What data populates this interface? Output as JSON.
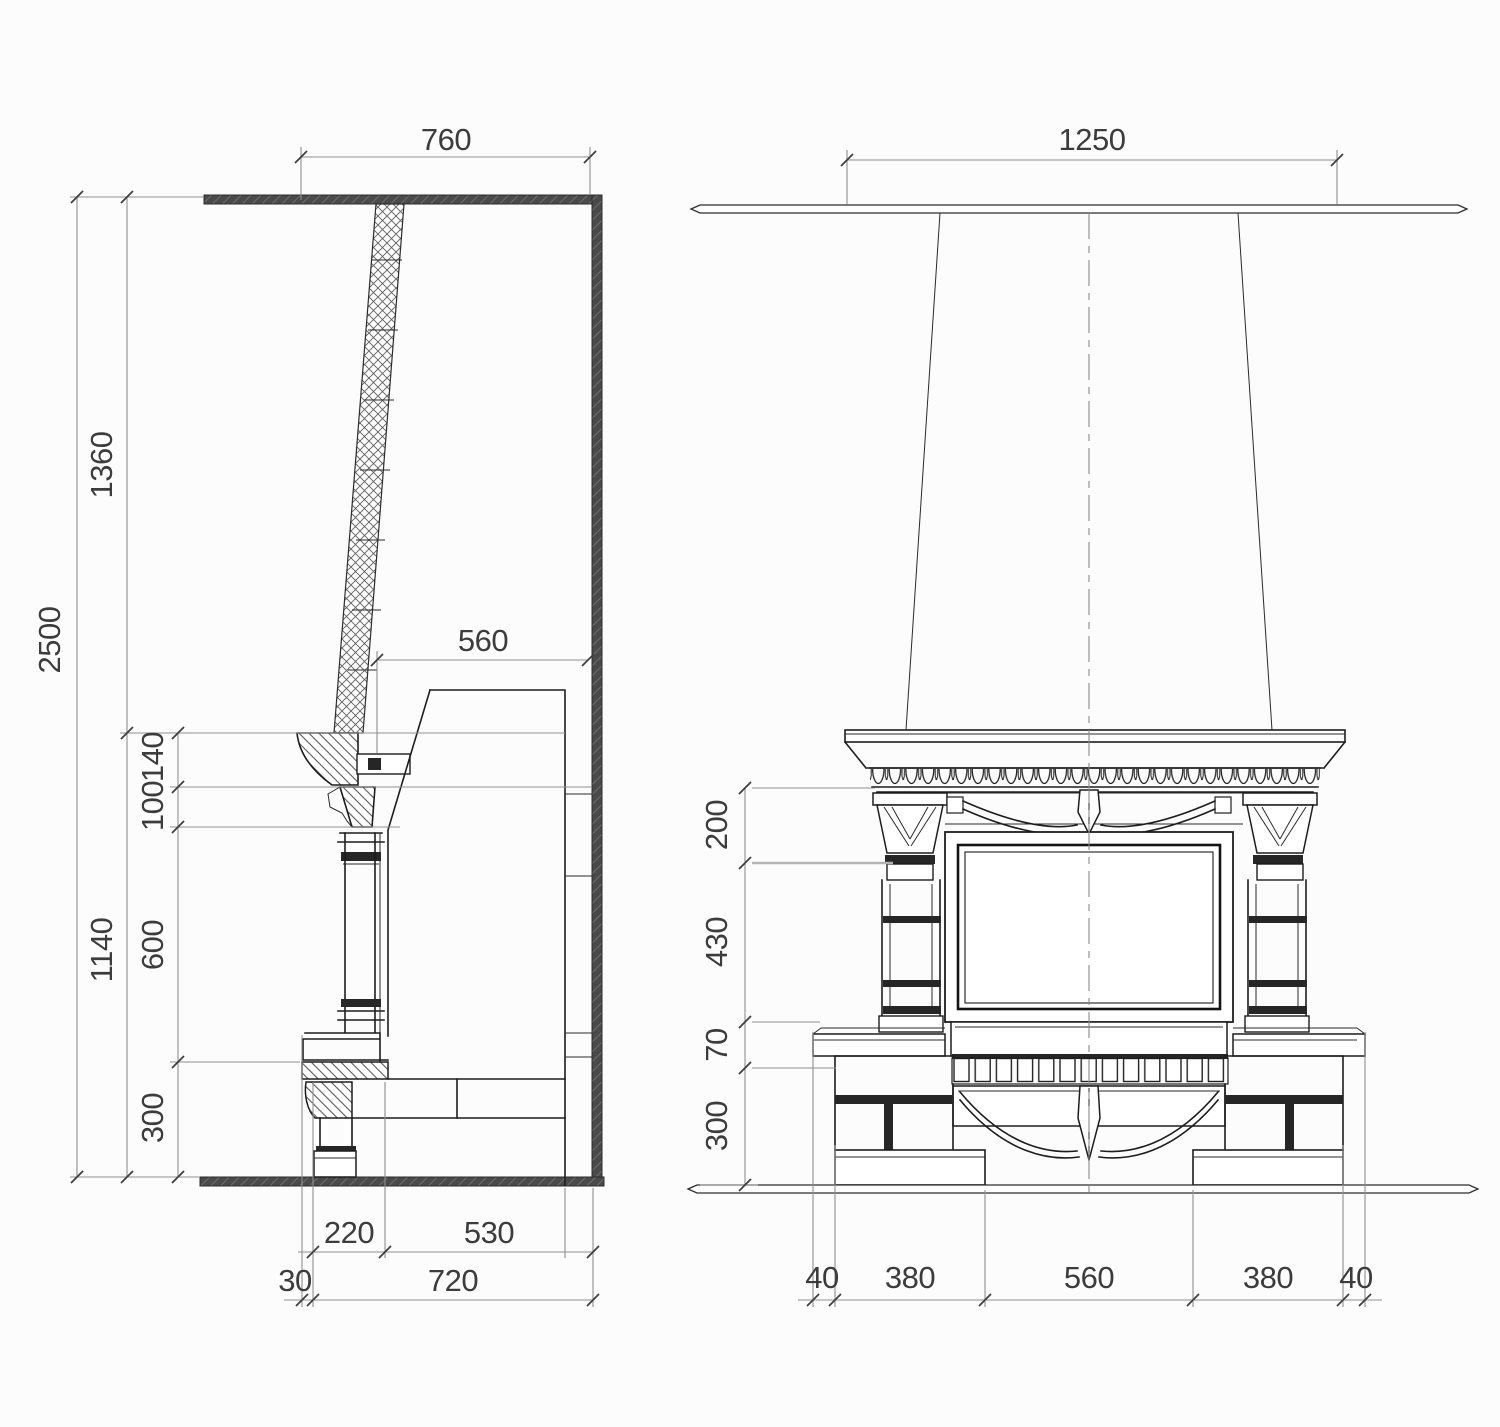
{
  "drawing": {
    "title": "fireplace construction drawing",
    "units": "mm",
    "colors": {
      "line": "#1d1d1d",
      "dimension": "#8f8f8f",
      "text": "#3c3c3c",
      "wall": "#4a4a4a"
    }
  },
  "side_view": {
    "label": "side section view",
    "dims": {
      "flue_width_top": "760",
      "depth_to_wall": "560",
      "ceiling_height": "2500",
      "upper_wall_height": "1360",
      "fireplace_height": "1140",
      "shelf_thickness": "140",
      "corbel_height": "100",
      "column_height": "600",
      "base_height": "300",
      "hearth_depth": "220",
      "body_depth": "530",
      "plinth_offset": "30",
      "total_depth": "720"
    }
  },
  "front_view": {
    "label": "front elevation view",
    "dims": {
      "flue_width_ceiling": "1250",
      "capital_height": "200",
      "opening_height": "430",
      "shelf_band_height": "70",
      "base_height": "300",
      "left_overhang": "40",
      "left_pier_width": "380",
      "opening_width": "560",
      "right_pier_width": "380",
      "right_overhang": "40"
    }
  }
}
